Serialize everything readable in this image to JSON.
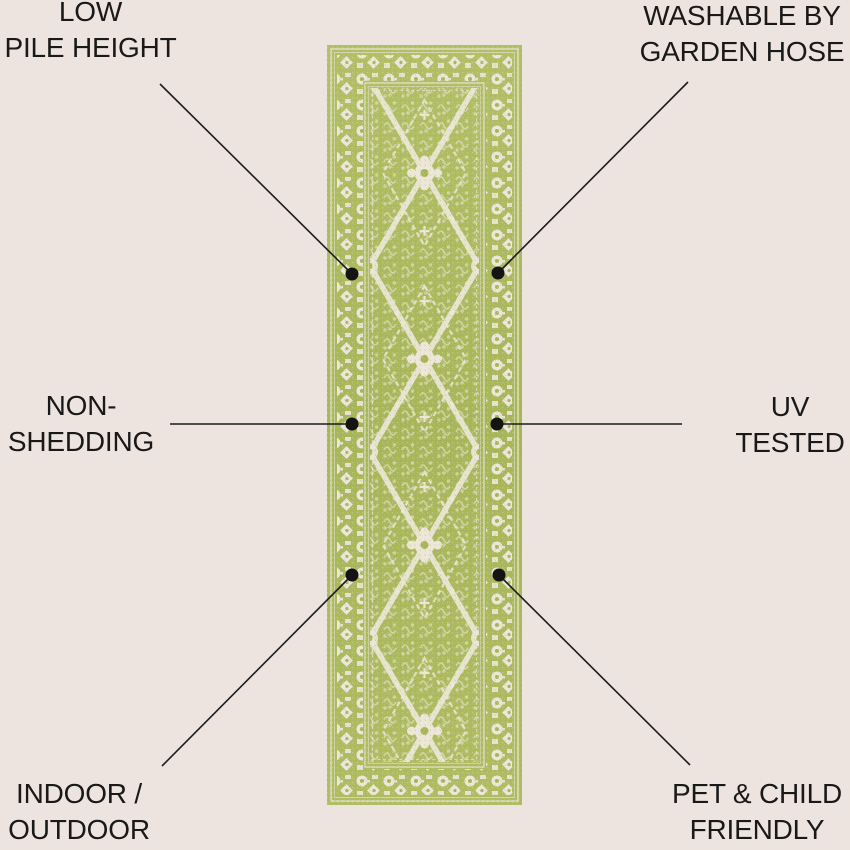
{
  "page": {
    "type": "product-feature-infographic",
    "background_color": "#EDE4E0",
    "text_color": "#191919",
    "callout_line_color": "#1C1C1C"
  },
  "product": {
    "description": "green and cream ornamental runner rug",
    "colors": {
      "rug_green": "#ACB95E",
      "rug_green_dark": "#9CAC4E",
      "rug_cream": "#EAE5D5"
    }
  },
  "callouts": [
    {
      "id": "low-pile-height",
      "lines": [
        "LOW",
        "PILE HEIGHT"
      ]
    },
    {
      "id": "washable-by-garden-hose",
      "lines": [
        "WASHABLE BY",
        "GARDEN HOSE"
      ]
    },
    {
      "id": "non-shedding",
      "lines": [
        "NON-",
        "SHEDDING"
      ]
    },
    {
      "id": "uv-tested",
      "lines": [
        "UV",
        "TESTED"
      ]
    },
    {
      "id": "indoor-outdoor",
      "lines": [
        "INDOOR /",
        "OUTDOOR"
      ]
    },
    {
      "id": "pet-child-friendly",
      "lines": [
        "PET & CHILD",
        "FRIENDLY"
      ]
    }
  ]
}
